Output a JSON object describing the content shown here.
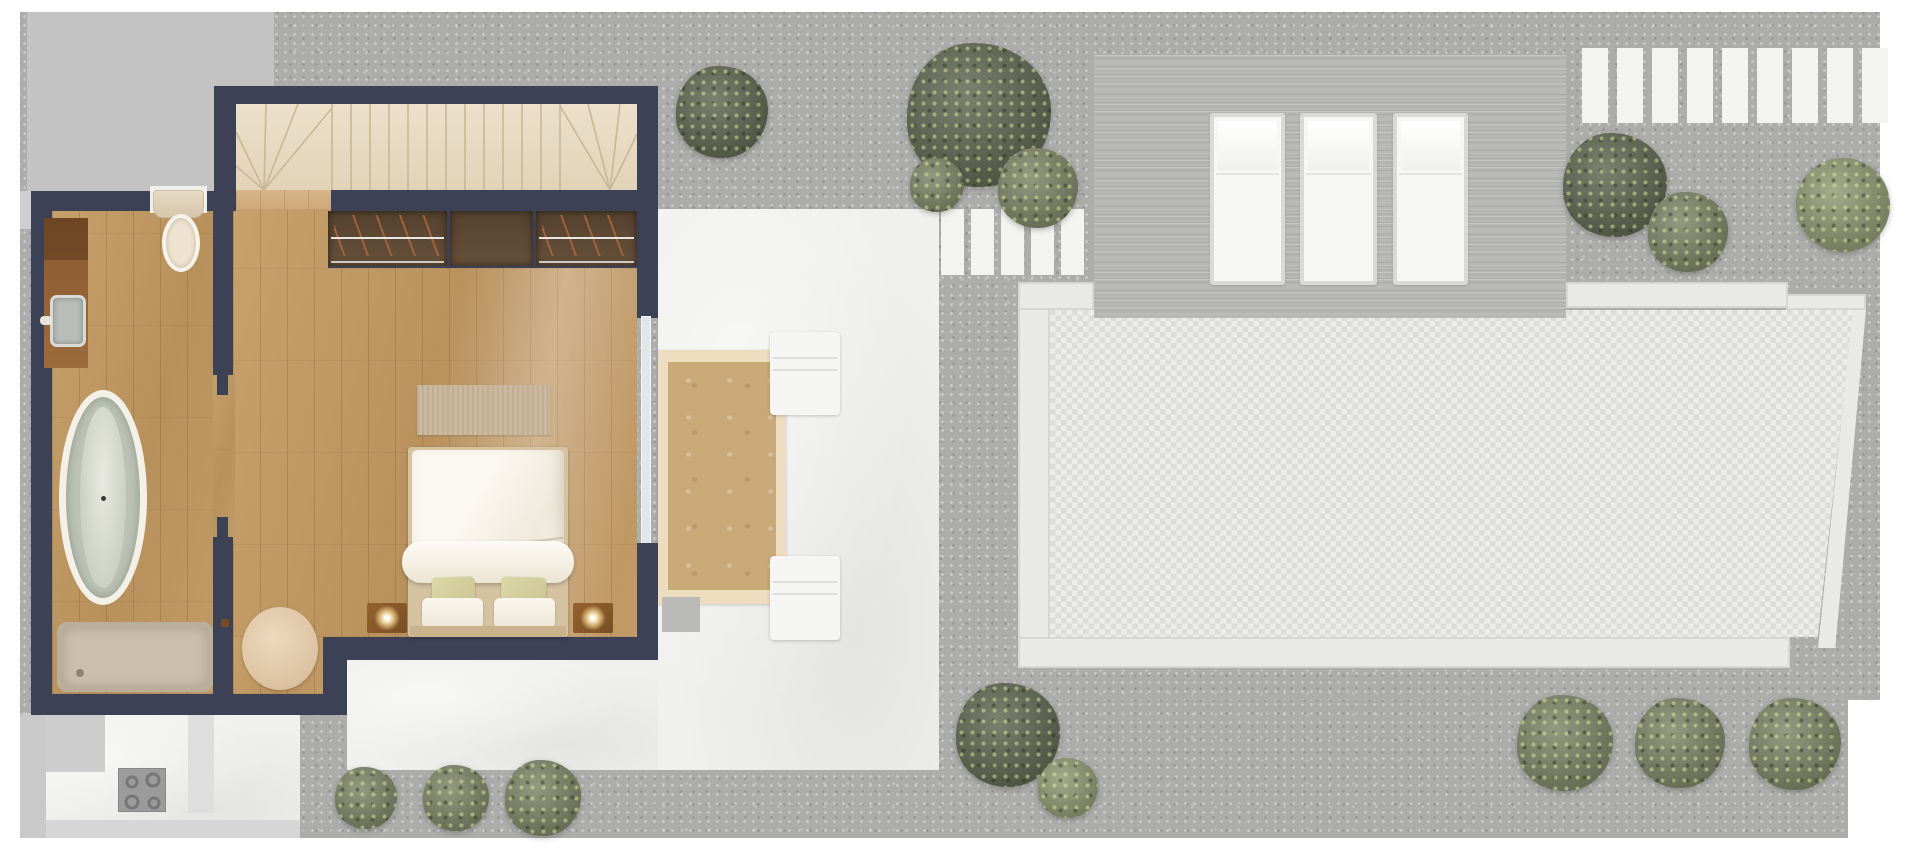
{
  "document": {
    "kind": "architectural floor plan (top-down 3D render)",
    "canvas": {
      "width": 1920,
      "height": 867
    },
    "visible_text": []
  },
  "palette": {
    "wall_navy": "#3c4156",
    "wood_floor": "#c19a67",
    "hall_wood": "#d3b085",
    "stairs_marble": "#e7dac4",
    "gravel": "#acacab",
    "neighbor_block": "#c3c3c3",
    "terrace_white": "#f0f0ee",
    "deck_planks": "#b7b7b6",
    "pool_tile": "#e4e4e2",
    "pool_border": "#e9e9e7",
    "wardrobe_wood": "#55422e",
    "copper_hangers": "#a8643c",
    "bed_linen": "#f6f2e8",
    "accent_pillow": "#d9d4a4",
    "nightstand_wood": "#8a5a2e",
    "tub_interior": "#bcc3b6",
    "shower_tray": "#cabfab",
    "lounge_platform": "#eddcbd",
    "lounge_platform_inner": "#c9a977",
    "shrub_dark": "#5e6650",
    "shrub_olive": "#7d8465",
    "shrub_light": "#8f9871"
  },
  "house": {
    "rooms": [
      {
        "name": "staircase hall",
        "features": [
          "winder staircase with fanned treads",
          "oak landing strip"
        ]
      },
      {
        "name": "bedroom",
        "furniture": [
          "double bed with white duvet and rolled throw",
          "2 khaki accent pillows",
          "2 white pillows",
          "2 timber nightstands with lit lamps",
          "striped area rug at bed foot",
          "built-in wardrobe: 2 hanging sections with copper hangers + 1 shelf section",
          "round beige rug",
          "glazed sliding door to terrace"
        ]
      },
      {
        "name": "bathroom",
        "fixtures": [
          "freestanding oval bathtub",
          "walk-in shower tray with drain",
          "wall-hung toilet in niche",
          "timber vanity with square basin and wall tap"
        ]
      }
    ],
    "lower_level_glimpse": {
      "name": "kitchen below",
      "fixtures": [
        "4-ring cooktop",
        "counter blocks"
      ]
    }
  },
  "outdoor": {
    "terrace": {
      "finish": "white stone",
      "furniture": [
        "timber lounge platform with cream border",
        "2 white lounge chairs",
        "grey door mat"
      ]
    },
    "stepping_stones": {
      "count": 5
    },
    "timber_deck": {
      "loungers": 3
    },
    "pool": {
      "finish": "grey-white mosaic tile",
      "border": "white stone surround, slanted right edge"
    },
    "garden_steps": {
      "count": 9
    },
    "shrubs": {
      "top_left_tree": 1,
      "top_center_tree_cluster": 3,
      "right_of_deck_cluster": 2,
      "round_bush_far_right": 1,
      "bottom_center_cluster": 2,
      "bottom_left_row": 3,
      "bottom_right_row": 3
    }
  }
}
